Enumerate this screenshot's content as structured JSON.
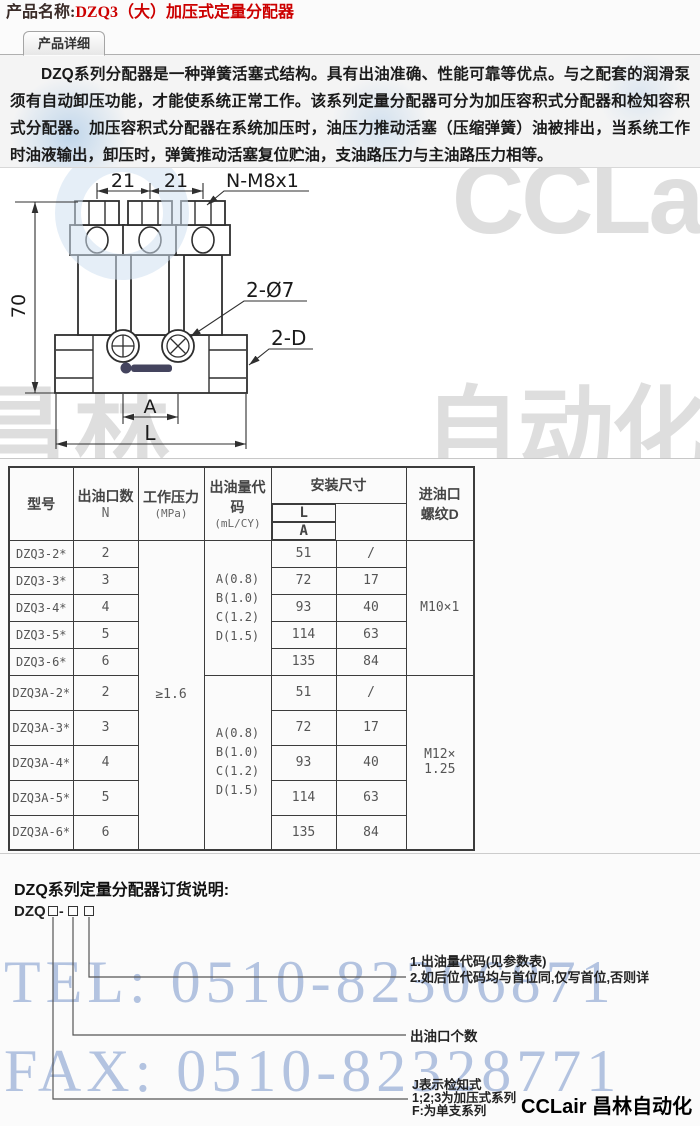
{
  "header": {
    "label": "产品名称:",
    "value": "DZQ3（大）加压式定量分配器",
    "accent_color": "#cc0000"
  },
  "tab": {
    "label": "产品详细"
  },
  "intro": {
    "text": "DZQ系列分配器是一种弹簧活塞式结构。具有出油准确、性能可靠等优点。与之配套的润滑泵须有自动卸压功能，才能使系统正常工作。该系列定量分配器可分为加压容积式分配器和检知容积式分配器。加压容积式分配器在系统加压时，油压力推动活塞（压缩弹簧）油被排出，当系统工作时油液输出，卸压时，弹簧推动活塞复位贮油，支油路压力与主油路压力相等。"
  },
  "drawing": {
    "dims": {
      "d21a": "21",
      "d21b": "21",
      "nm8": "N-M8x1",
      "d70": "70",
      "d7": "2-Ø7",
      "dd": "2-D",
      "a": "A",
      "l": "L"
    }
  },
  "watermark": {
    "cclair": "CCLair",
    "changlin_left": "昌林",
    "changlin_right": "自动化",
    "tel": "TEL: 0510-82306871",
    "fax": "FAX: 0510-82328771",
    "blue_color": "#b3c3e0",
    "gray_color": "#dedede"
  },
  "table": {
    "headers": {
      "model": "型号",
      "outlets1": "出油口数",
      "outlets2": "N",
      "pressure1": "工作压力",
      "pressure2": "(MPa)",
      "code1": "出油量代",
      "code2": "码",
      "code3": "(mL/CY)",
      "mount": "安装尺寸",
      "col_l": "L",
      "col_a": "A",
      "inlet1": "进油口",
      "inlet2": "螺纹D"
    },
    "pressure": "≥1.6",
    "codes": [
      "A(0.8)",
      "B(1.0)",
      "C(1.2)",
      "D(1.5)"
    ],
    "thread_g1": "M10×1",
    "thread_g2_1": "M12×",
    "thread_g2_2": "1.25",
    "rows": [
      {
        "model": "DZQ3-2*",
        "n": "2",
        "l": "51",
        "a": "/"
      },
      {
        "model": "DZQ3-3*",
        "n": "3",
        "l": "72",
        "a": "17"
      },
      {
        "model": "DZQ3-4*",
        "n": "4",
        "l": "93",
        "a": "40"
      },
      {
        "model": "DZQ3-5*",
        "n": "5",
        "l": "114",
        "a": "63"
      },
      {
        "model": "DZQ3-6*",
        "n": "6",
        "l": "135",
        "a": "84"
      },
      {
        "model": "DZQ3A-2*",
        "n": "2",
        "l": "51",
        "a": "/"
      },
      {
        "model": "DZQ3A-3*",
        "n": "3",
        "l": "72",
        "a": "17"
      },
      {
        "model": "DZQ3A-4*",
        "n": "4",
        "l": "93",
        "a": "40"
      },
      {
        "model": "DZQ3A-5*",
        "n": "5",
        "l": "114",
        "a": "63"
      },
      {
        "model": "DZQ3A-6*",
        "n": "6",
        "l": "135",
        "a": "84"
      }
    ]
  },
  "ordering": {
    "heading": "DZQ系列定量分配器订货说明:",
    "prefix": "DZQ",
    "dash": "-",
    "ann1_l1": "1.出油量代码(见参数表)",
    "ann1_l2": "2.如后位代码均与首位同,仅写首位,否则详",
    "ann2": "出油口个数",
    "ann3_l1": "J表示检知式",
    "ann3_l2": "1;2;3为加压式系列",
    "ann3_l3": "F:为单支系列"
  },
  "footer": {
    "brand": "CCLair 昌林自动化"
  }
}
